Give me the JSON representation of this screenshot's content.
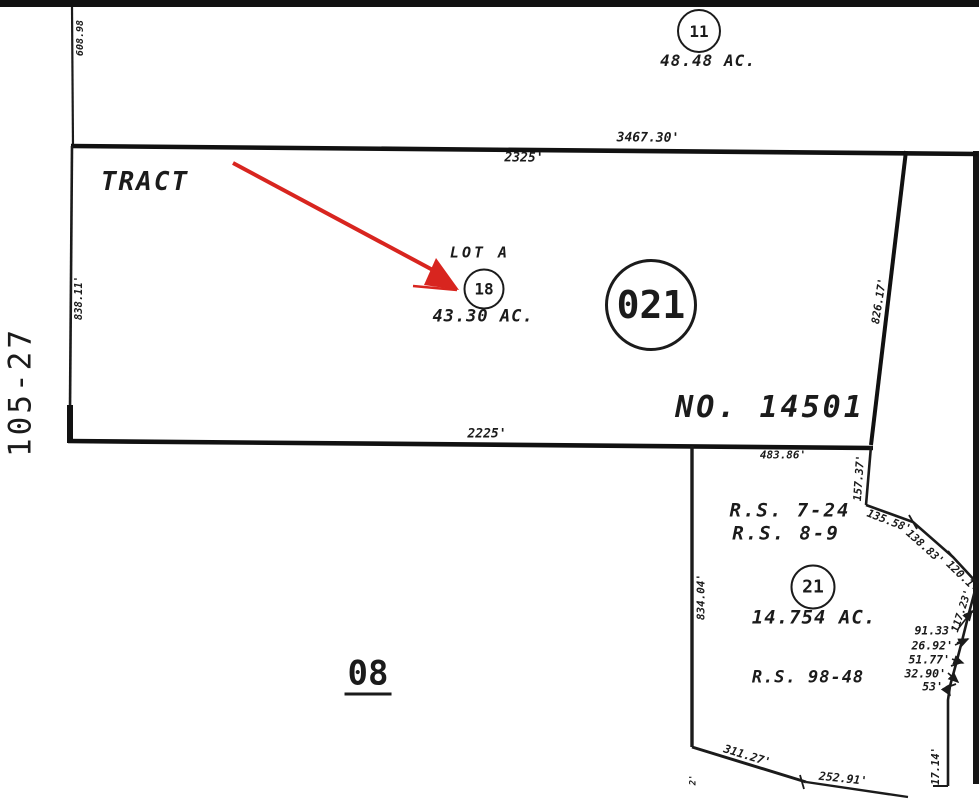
{
  "map": {
    "sheet_number": "105-27",
    "book_page": "08",
    "tract_label": "TRACT",
    "tract_number": "NO. 14501",
    "parcels": {
      "p11": {
        "number": "11",
        "area": "48.48 AC."
      },
      "p18": {
        "number": "18",
        "lot": "LOT A",
        "area": "43.30 AC."
      },
      "p021": {
        "number": "021"
      },
      "p21": {
        "number": "21",
        "area": "14.754 AC."
      }
    },
    "surveys": {
      "rs_7_24": "R.S. 7-24",
      "rs_8_9": "R.S. 8-9",
      "rs_98_48": "R.S. 98-48"
    },
    "dims": {
      "top_outer": "3467.30'",
      "top_inner": "2325'",
      "upper_left": "608.98",
      "left_side": "838.11'",
      "right_side": "826.17'",
      "bottom_inner": "2225'",
      "bottom_outer": "483.86'",
      "seg_157": "157.37'",
      "seg_135": "135.58'",
      "seg_138": "138.83'",
      "seg_120": "120.1",
      "seg_117": "117.23'",
      "vert_834": "834.04'",
      "small_91": "91.33'",
      "small_26": "26.92'",
      "small_51": "51.77'",
      "small_32": "32.90'",
      "small_53": "53'",
      "seg_311": "311.27'",
      "seg_252": "252.91'",
      "seg_17": "17.14'",
      "edge_partial": "2'"
    },
    "colors": {
      "ink": "#1b1b1b",
      "arrow_red": "#d8251f"
    }
  }
}
